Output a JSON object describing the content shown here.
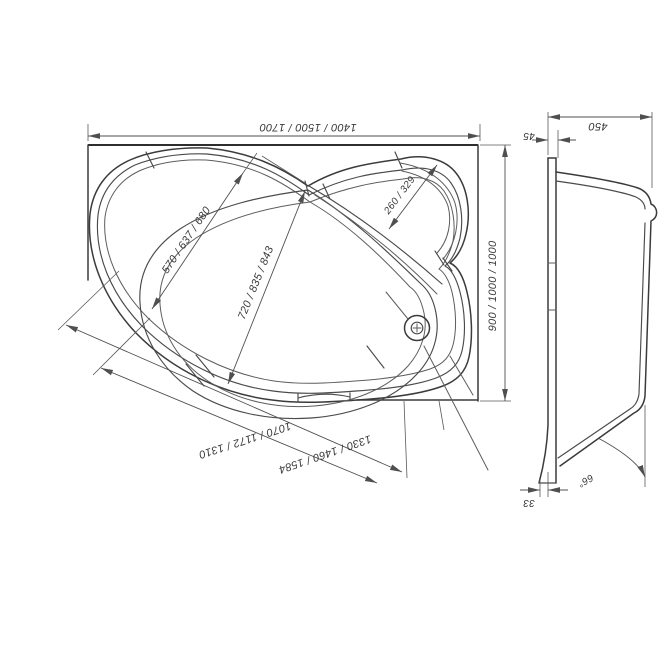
{
  "plan_view": {
    "width_label": "1400 / 1500 / 1700",
    "depth_label": "900 / 1000 / 1000",
    "inner_width_label": "570 / 637 / 680",
    "inner_length_label": "720 / 835 / 843",
    "headrest_width_label": "260 / 329",
    "front_edge_inner_label": "1070 / 1172 / 1310",
    "front_edge_outer_label": "1330 / 1460 / 1584"
  },
  "side_view": {
    "depth_label": "450",
    "rim_thickness_label": "45",
    "base_offset_label": "33",
    "angle_label": "66°"
  },
  "colors": {
    "line": "#3b3b3b",
    "dimension": "#4f4f4f",
    "text": "#3a3a3a",
    "background": "#ffffff"
  }
}
